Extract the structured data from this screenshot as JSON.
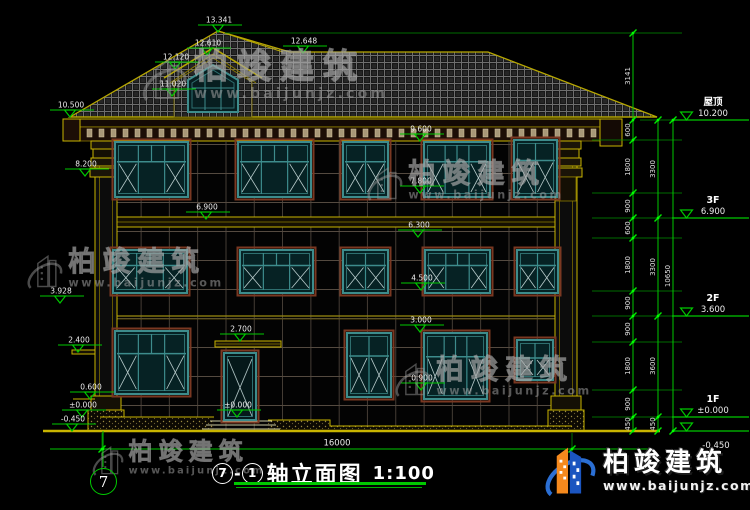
{
  "drawing": {
    "title": {
      "axis_start": "7",
      "dash": "-",
      "axis_end": "1",
      "text": "轴立面图",
      "scale": "1:100"
    },
    "axis_bubble": "7",
    "bottom_dim": {
      "label": "16000"
    },
    "level_marks": [
      {
        "t": "13.341",
        "ax": 218,
        "ay": 32
      },
      {
        "t": "12.610",
        "ax": 207,
        "ay": 55
      },
      {
        "t": "12.120",
        "ax": 175,
        "ay": 69
      },
      {
        "t": "11.020",
        "ax": 172,
        "ay": 96
      },
      {
        "t": "12.648",
        "ax": 303,
        "ay": 53
      },
      {
        "t": "10.500",
        "ax": 70,
        "ay": 117
      },
      {
        "t": "9.600",
        "ax": 420,
        "ay": 141
      },
      {
        "t": "8.200",
        "ax": 85,
        "ay": 176
      },
      {
        "t": "7.800",
        "ax": 420,
        "ay": 193
      },
      {
        "t": "6.900",
        "ax": 206,
        "ay": 219
      },
      {
        "t": "6.300",
        "ax": 418,
        "ay": 237
      },
      {
        "t": "4.500",
        "ax": 421,
        "ay": 290
      },
      {
        "t": "3.928",
        "ax": 60,
        "ay": 303
      },
      {
        "t": "3.000",
        "ax": 420,
        "ay": 332
      },
      {
        "t": "2.700",
        "ax": 240,
        "ay": 341
      },
      {
        "t": "2.400",
        "ax": 78,
        "ay": 352
      },
      {
        "t": "0.900",
        "ax": 421,
        "ay": 390
      },
      {
        "t": "0.600",
        "ax": 90,
        "ay": 399
      },
      {
        "t": "±0.000",
        "ax": 82,
        "ay": 417
      },
      {
        "t": "±0.000",
        "ax": 237,
        "ay": 417
      },
      {
        "t": "-0.450",
        "ax": 72,
        "ay": 431
      }
    ],
    "right_levels": [
      {
        "name": "屋顶",
        "value": "10.200",
        "y": 120
      },
      {
        "name": "3F",
        "value": "6.900",
        "y": 218
      },
      {
        "name": "2F",
        "value": "3.600",
        "y": 316
      },
      {
        "name": "1F",
        "value": "±0.000",
        "y": 417
      },
      {
        "name": "",
        "value": "-0.450",
        "y": 431,
        "below": true
      }
    ],
    "dim_chains": [
      {
        "x": 633,
        "ticks": [
          33,
          120,
          140,
          193,
          218,
          238,
          291,
          316,
          342,
          390,
          417,
          431
        ],
        "labels": [
          {
            "t": "3141",
            "y": 76
          },
          {
            "t": "600",
            "y": 130
          },
          {
            "t": "1800",
            "y": 167
          },
          {
            "t": "900",
            "y": 206
          },
          {
            "t": "600",
            "y": 228
          },
          {
            "t": "1800",
            "y": 265
          },
          {
            "t": "900",
            "y": 303
          },
          {
            "t": "900",
            "y": 329
          },
          {
            "t": "1800",
            "y": 366
          },
          {
            "t": "900",
            "y": 404
          },
          {
            "t": "450",
            "y": 424
          }
        ]
      },
      {
        "x": 658,
        "ticks": [
          120,
          218,
          316,
          417,
          431
        ],
        "labels": [
          {
            "t": "3300",
            "y": 169
          },
          {
            "t": "3300",
            "y": 267
          },
          {
            "t": "3600",
            "y": 366
          },
          {
            "t": "450",
            "y": 424
          }
        ]
      },
      {
        "x": 673,
        "ticks": [
          120,
          431
        ],
        "labels": [
          {
            "t": "10650",
            "y": 276
          }
        ]
      }
    ],
    "ext_lines": [
      [
        592,
        140,
        682,
        140
      ],
      [
        592,
        193,
        682,
        193
      ],
      [
        592,
        218,
        682,
        218
      ],
      [
        592,
        238,
        682,
        238
      ],
      [
        592,
        291,
        682,
        291
      ],
      [
        592,
        316,
        682,
        316
      ],
      [
        592,
        342,
        682,
        342
      ],
      [
        592,
        390,
        682,
        390
      ],
      [
        592,
        417,
        682,
        417
      ],
      [
        225,
        33,
        682,
        33
      ],
      [
        640,
        120,
        672,
        120
      ]
    ],
    "facade": {
      "windows": [
        {
          "x": 115,
          "y": 142,
          "w": 73,
          "h": 55,
          "type": "A"
        },
        {
          "x": 238,
          "y": 142,
          "w": 73,
          "h": 55,
          "type": "A"
        },
        {
          "x": 343,
          "y": 142,
          "w": 45,
          "h": 55,
          "type": "B"
        },
        {
          "x": 424,
          "y": 142,
          "w": 66,
          "h": 55,
          "type": "A"
        },
        {
          "x": 514,
          "y": 140,
          "w": 43,
          "h": 57,
          "type": "B"
        },
        {
          "x": 113,
          "y": 250,
          "w": 74,
          "h": 43,
          "type": "A"
        },
        {
          "x": 240,
          "y": 250,
          "w": 73,
          "h": 43,
          "type": "A"
        },
        {
          "x": 343,
          "y": 250,
          "w": 45,
          "h": 43,
          "type": "B"
        },
        {
          "x": 425,
          "y": 250,
          "w": 65,
          "h": 43,
          "type": "A"
        },
        {
          "x": 517,
          "y": 250,
          "w": 41,
          "h": 43,
          "type": "B"
        },
        {
          "x": 115,
          "y": 331,
          "w": 73,
          "h": 63,
          "type": "A"
        },
        {
          "x": 347,
          "y": 333,
          "w": 44,
          "h": 64,
          "type": "B"
        },
        {
          "x": 424,
          "y": 333,
          "w": 63,
          "h": 66,
          "type": "A"
        },
        {
          "x": 517,
          "y": 340,
          "w": 36,
          "h": 40,
          "type": "C"
        }
      ],
      "door": {
        "x": 224,
        "y": 353,
        "w": 32,
        "h": 67,
        "type": "D"
      }
    },
    "watermark": {
      "brand": "柏竣建筑",
      "url": "www.baijunjz.com",
      "instances": [
        {
          "x": 136,
          "y": 50,
          "s": 1.0
        },
        {
          "x": 362,
          "y": 160,
          "s": 0.8
        },
        {
          "x": 22,
          "y": 248,
          "s": 0.8
        },
        {
          "x": 390,
          "y": 356,
          "s": 0.8
        },
        {
          "x": 88,
          "y": 440,
          "s": 0.7
        }
      ]
    },
    "logo": {
      "brand": "柏竣建筑",
      "url": "www.baijunjz.com"
    },
    "colors": {
      "dim_green": "#00c800",
      "tick_green": "#00e800",
      "ext_green": "#009000",
      "line_yellow": "#c8b400",
      "frame_teal": "#3d8c8c",
      "trim_brown": "#7a3822",
      "logo_blue": "#1b55c0",
      "logo_orange": "#f5891d"
    }
  }
}
